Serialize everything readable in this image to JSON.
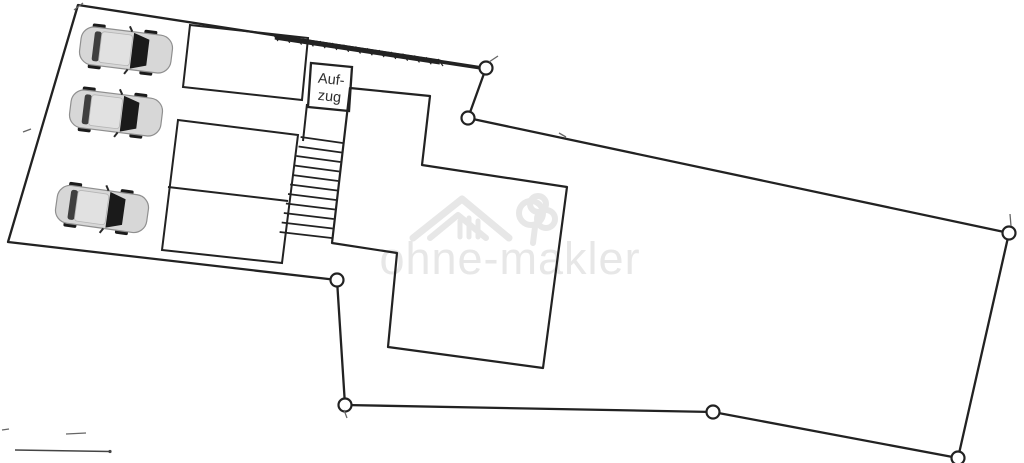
{
  "document": {
    "type": "site-plan-floorplan-scan",
    "background": "#ffffff"
  },
  "labels": {
    "elevator_line1": "Auf-",
    "elevator_line2": "zug"
  },
  "watermark": {
    "text": "ohne-makler",
    "logo": "house-roof-and-tree-icon",
    "color": "#e7e7e7"
  },
  "colors": {
    "ink": "#222222",
    "faint_ink": "#666666",
    "car_body": "#d7d7d7",
    "car_body_stroke": "#8f8f8f",
    "car_roof": "#e1e1e1",
    "car_glass": "#1a1a1a",
    "car_rear_band": "#3f3f3f",
    "car_wheel": "#1b1b1b",
    "marker_fill": "#ffffff"
  },
  "plan": {
    "boundary_points": [
      [
        78,
        5
      ],
      [
        486,
        68
      ],
      [
        468,
        118
      ],
      [
        1009,
        233
      ],
      [
        958,
        458
      ],
      [
        713,
        412
      ],
      [
        345,
        405
      ],
      [
        337,
        280
      ],
      [
        8,
        242
      ]
    ],
    "vertex_markers": [
      [
        486,
        68
      ],
      [
        468,
        118
      ],
      [
        1009,
        233
      ],
      [
        958,
        458
      ],
      [
        713,
        412
      ],
      [
        345,
        405
      ],
      [
        337,
        280
      ]
    ],
    "marker_radius": 6.5,
    "wall_band": {
      "from": [
        275,
        37
      ],
      "to": [
        440,
        62
      ],
      "width": 5
    },
    "wall_band2": {
      "from": [
        440,
        62
      ],
      "to": [
        483,
        68.5
      ],
      "width": 3
    },
    "rooms": {
      "top_rect": [
        [
          190,
          25
        ],
        [
          308,
          38
        ],
        [
          302,
          100
        ],
        [
          183,
          87
        ]
      ],
      "mid_rect": [
        [
          178,
          120
        ],
        [
          298,
          135
        ],
        [
          282,
          263
        ],
        [
          162,
          250
        ]
      ],
      "elevator_box": [
        [
          311,
          63
        ],
        [
          352,
          67
        ],
        [
          349,
          111
        ],
        [
          308,
          107
        ]
      ]
    },
    "mid_divider": [
      [
        168,
        187
      ],
      [
        288,
        201
      ]
    ],
    "building": [
      [
        350,
        88
      ],
      [
        430,
        96
      ],
      [
        422,
        165
      ],
      [
        567,
        187
      ],
      [
        543,
        368
      ],
      [
        388,
        347
      ],
      [
        397,
        253
      ],
      [
        332,
        243
      ]
    ],
    "stairs": {
      "step_count": 11,
      "y_start": 143,
      "y_end": 238,
      "wall_x_at": {
        "x0": 350,
        "y0": 88,
        "slope": -0.116
      },
      "base_length": 42,
      "length_grow": 1.0,
      "rise": 6,
      "left_rail": [
        [
          307,
          104
        ],
        [
          303,
          141
        ]
      ]
    },
    "cars": [
      {
        "cx": 126,
        "cy": 50,
        "rot": 7
      },
      {
        "cx": 116,
        "cy": 113,
        "rot": 7
      },
      {
        "cx": 102,
        "cy": 209,
        "rot": 8
      }
    ],
    "scale_bar": {
      "from": [
        15,
        450
      ],
      "to": [
        110,
        451.5
      ]
    },
    "stray_marks": [
      [
        [
          23,
          132
        ],
        [
          31,
          129
        ]
      ],
      [
        [
          2,
          430
        ],
        [
          9,
          429
        ]
      ],
      [
        [
          66,
          434
        ],
        [
          86,
          433
        ]
      ],
      [
        [
          559,
          133
        ],
        [
          566,
          137
        ]
      ],
      [
        [
          74,
          10
        ],
        [
          83,
          3
        ]
      ],
      [
        [
          344,
          410
        ],
        [
          347,
          418
        ]
      ],
      [
        [
          489,
          62
        ],
        [
          498,
          56
        ]
      ],
      [
        [
          1010,
          214
        ],
        [
          1011,
          226
        ]
      ]
    ],
    "elevator_label_pos": {
      "x": 330,
      "y1": 84,
      "y2": 101,
      "rotate": 6
    },
    "watermark_layout": {
      "text_x": 510,
      "text_y": 274
    }
  }
}
